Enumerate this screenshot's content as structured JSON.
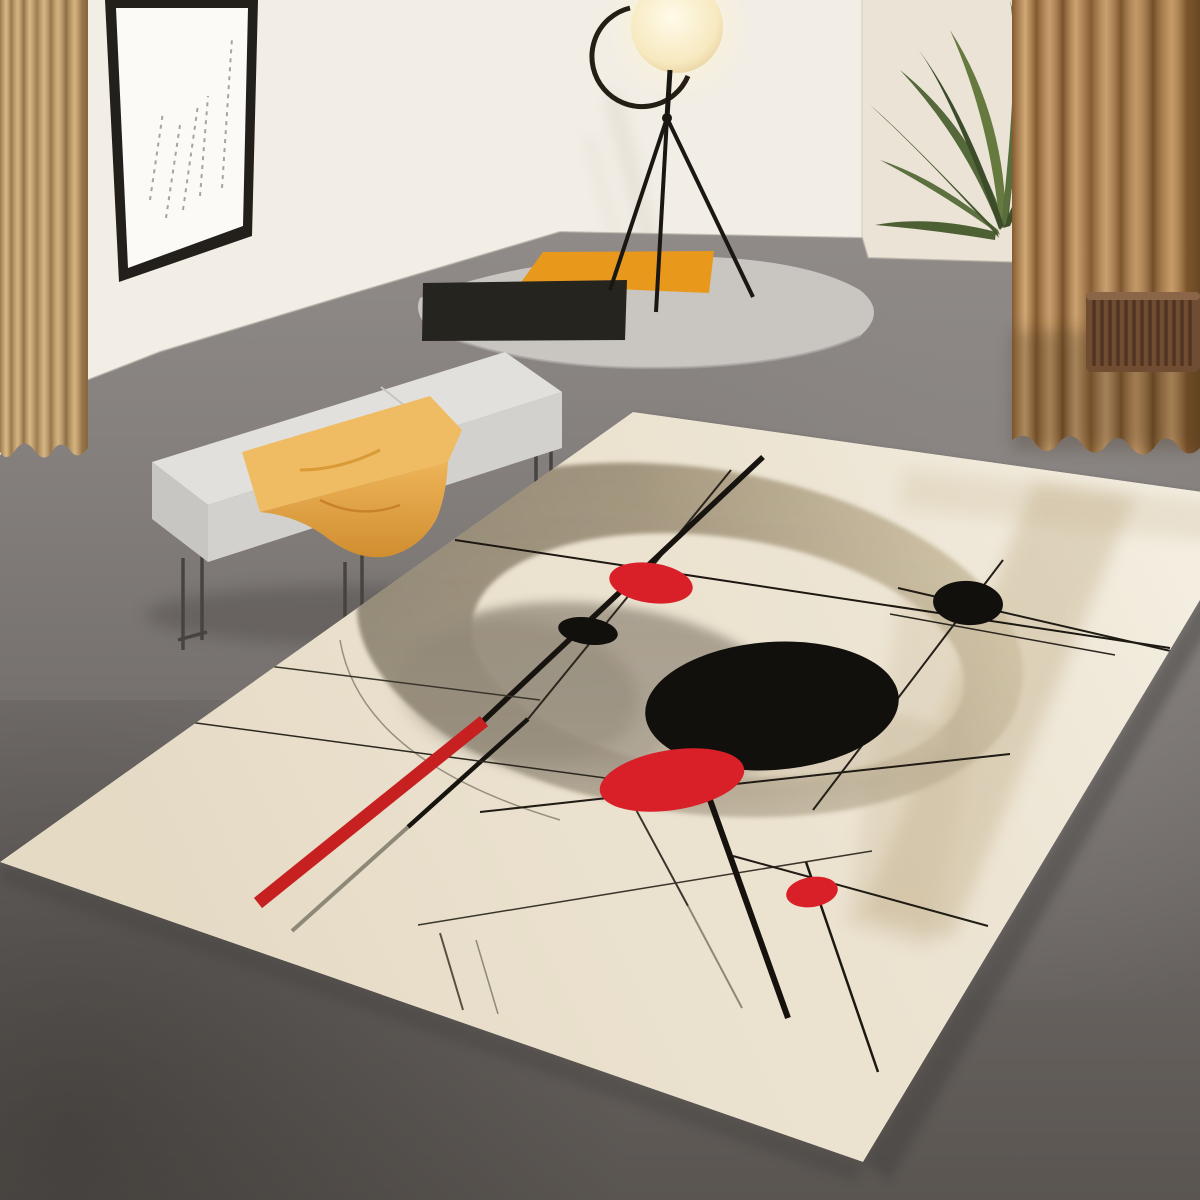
{
  "image_type": "product lifestyle photograph (no text visible)",
  "scene": {
    "setting": "modern minimalist room with gray concrete floor and white wall",
    "focal_product": "large abstract geometric area rug shown in perspective",
    "elements": [
      {
        "name": "framed-artwork",
        "description": "thin black frame, white mat, five diagonal sketched dashed lines"
      },
      {
        "name": "tripod-floor-lamp",
        "description": "glowing round disc head held by black C-ring on three thin black legs"
      },
      {
        "name": "oval-accent-mat",
        "description": "small light-gray oval mat with orange band and black band at its left end"
      },
      {
        "name": "bench",
        "description": "light gray upholstered bench on thin metal legs"
      },
      {
        "name": "throw-blanket",
        "description": "yellow-orange blanket draped over bench"
      },
      {
        "name": "left-curtain",
        "description": "light tan velvet curtain panel"
      },
      {
        "name": "right-curtain",
        "description": "darker brown velvet curtain panels"
      },
      {
        "name": "palm-plant",
        "description": "green palm fronds behind right curtain"
      },
      {
        "name": "radiator",
        "description": "ribbed dark brown wall radiator"
      },
      {
        "name": "area-rug",
        "description": "cream rug with tan ring, large black ellipse, red circles, red diagonal bar and thin black crossing lines"
      }
    ],
    "rug_design": {
      "background": "cream",
      "shapes": [
        {
          "name": "tan-ring",
          "type": "annulus",
          "tone": "olive to light tan"
        },
        {
          "name": "large-black-ellipse"
        },
        {
          "name": "red-circle-upper"
        },
        {
          "name": "red-ellipse-lower"
        },
        {
          "name": "red-dot-small"
        },
        {
          "name": "black-circle-small-left"
        },
        {
          "name": "black-circle-small-right"
        },
        {
          "name": "red-diagonal-bar"
        },
        {
          "name": "thin-crossing-lines",
          "count": 19
        }
      ]
    }
  },
  "colors": {
    "wall": "#f2eee6",
    "wall_right": "#eae3d6",
    "floor_top": "#8f8a88",
    "floor_dark": "#595450",
    "curtain_left_base": "#c4a271",
    "curtain_right_base": "#a9784a",
    "radiator_brown": "#6f4c32",
    "plant_green": "#5c6f3c",
    "lamp_glow": "#fdf3d4",
    "frame_black": "#23201c",
    "art_white": "#fbfaf7",
    "oval_gray": "#c9c6c2",
    "accent_orange": "#e8991c",
    "band_black": "#26241f",
    "bench_gray": "#e1e0dc",
    "blanket_yellow": "#f0bc63",
    "rug_cream": "#ebe2d0",
    "ring_tan": "#cfc2a4",
    "ring_olive": "#8a8170",
    "design_black": "#12100c",
    "rug_red": "#d92029",
    "red_bar": "#c62020",
    "line_dark": "#1c1811",
    "line_gray": "#8e8878"
  }
}
